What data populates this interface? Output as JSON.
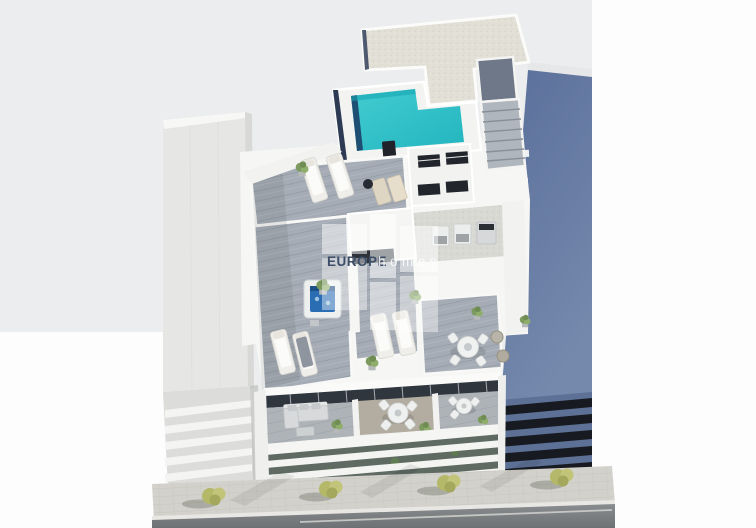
{
  "scene_meta": {
    "description": "Aerial 3D architectural render of a modern apartment building with a rooftop pool, solarium terraces, furnished balconies, neighbouring buildings and a street with trees",
    "width": 756,
    "height": 528
  },
  "watermark": {
    "brand_bold": "EUROPE",
    "brand_light": "homes"
  },
  "palette": {
    "backdrop": "#ebedee",
    "backdrop_white": "#fdfdfe",
    "pool_water": "#2fc3c9",
    "pool_edge_shadow": "#1c4168",
    "roof_tiles": "#e2dfd6",
    "deck_planks": "#a5acb5",
    "white_walls": "#f6f6f4",
    "neighbor_left": "#e6e7e5",
    "neighbor_right": "#64799f",
    "facade_glazing": "#30363e",
    "window_band_dark": "#171b21",
    "gravel": "#d9d9d4",
    "sidewalk": "#d2d1cb",
    "road": "#7e8184",
    "foliage": "#8fae6b",
    "street_tree": "#b4b868",
    "jacuzzi_water": "#2a6db2",
    "watermark_navy": "#3d4e68",
    "watermark_light": "rgba(255,255,255,0.85)"
  }
}
